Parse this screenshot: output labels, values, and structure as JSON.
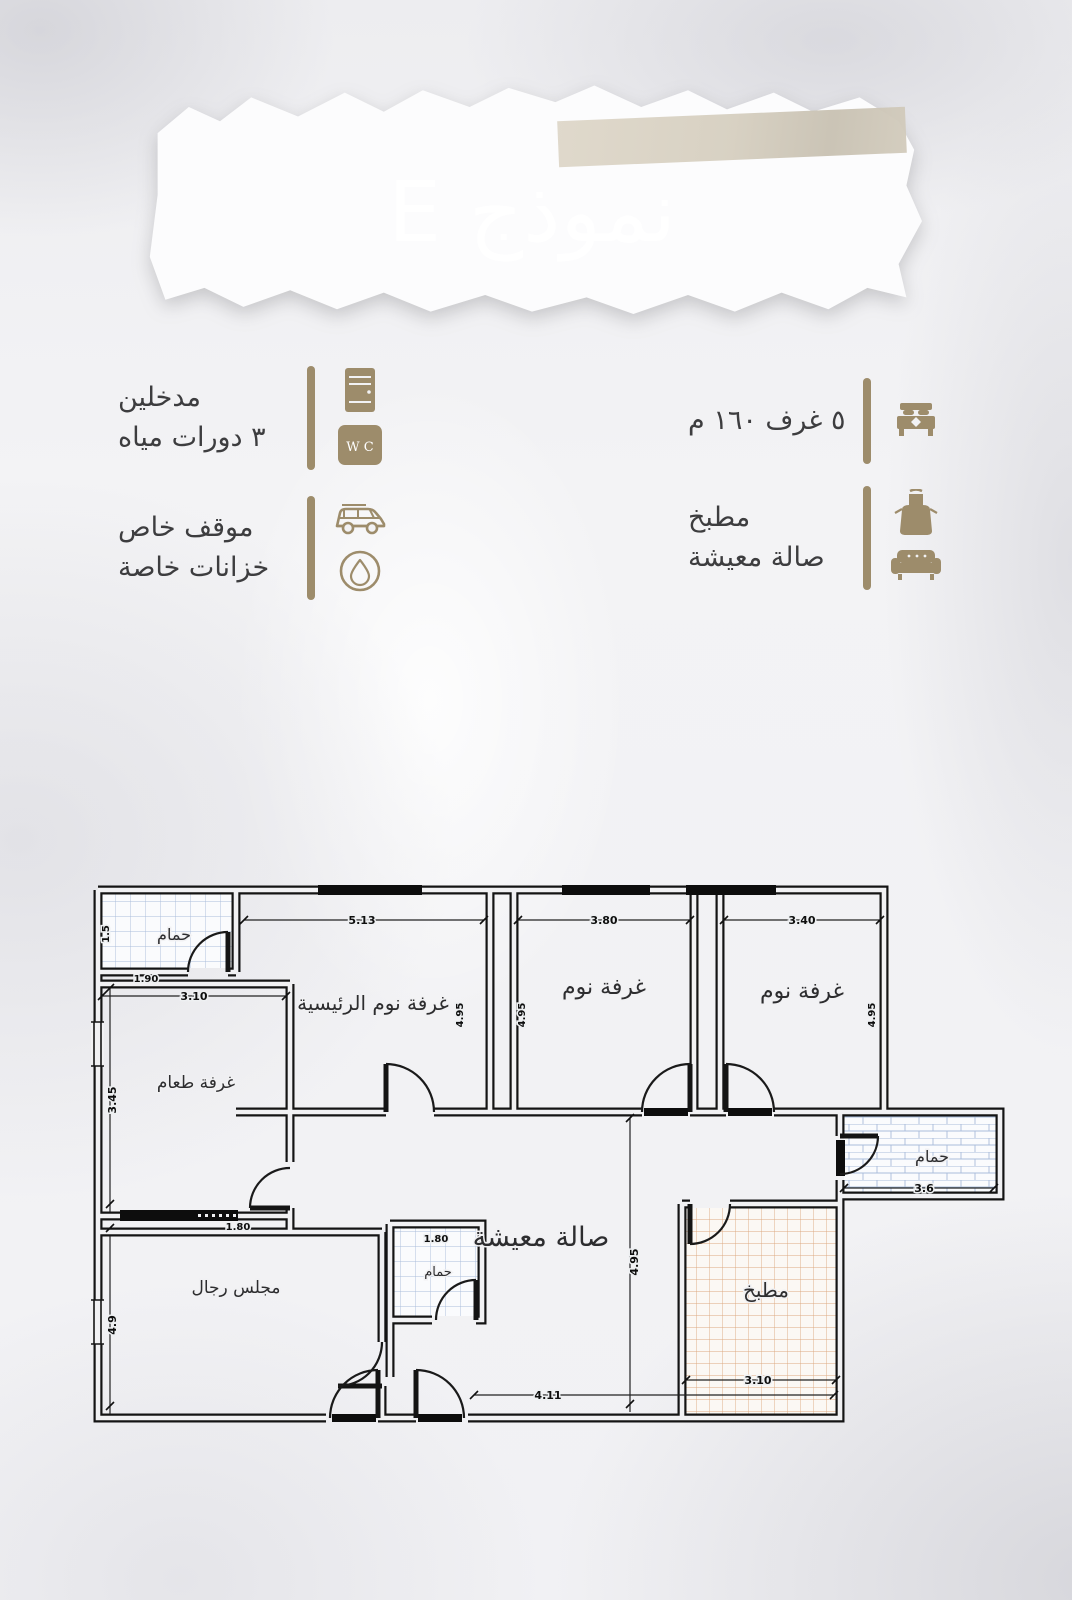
{
  "banner": {
    "title": "نموذج E",
    "brown": "#9b8a69",
    "tape": "#d6cfc0"
  },
  "accent": "#9d8c6b",
  "features_left": [
    {
      "line1": "مدخلين",
      "line2": "٣ دورات مياه",
      "icon1": "door-icon",
      "icon2": "wc-icon",
      "wc_text": "W C"
    },
    {
      "line1": "موقف خاص",
      "line2": "خزانات خاصة",
      "icon1": "car-icon",
      "icon2": "water-tank-icon"
    }
  ],
  "features_right": [
    {
      "line1": "٥ غرف ١٦٠ م",
      "icon1": "bed-icon"
    },
    {
      "line1": "مطبخ",
      "line2": "صالة معيشة",
      "icon1": "apron-icon",
      "icon2": "sofa-icon"
    }
  ],
  "floorplan": {
    "rooms": {
      "bath_top_left": "حمام",
      "master_bedroom": "غرفة نوم الرئيسية",
      "bedroom_2": "غرفة نوم",
      "bedroom_3": "غرفة نوم",
      "dining": "غرفة طعام",
      "majlis": "مجلس رجال",
      "living": "صالة معيشة",
      "kitchen": "مطبخ",
      "bath_right": "حمام",
      "bath_small": "حمام"
    },
    "dims": {
      "master_top": "5.13",
      "bed2_top": "3.80",
      "bed3_top": "3.40",
      "master_side": "4.95",
      "bed2_side": "4.95",
      "bed3_side": "4.95",
      "dining_top": "3.10",
      "dining_side": "3.45",
      "majlis_top": "1.80",
      "majlis_side": "4.9",
      "bath1_w": "1.90",
      "bath1_h": "1.5",
      "bath_small_w": "1.80",
      "bath_right_w": "3.6",
      "living_mid": "4.95",
      "living_bottom": "4.11",
      "kitchen_bottom": "3.10"
    }
  }
}
